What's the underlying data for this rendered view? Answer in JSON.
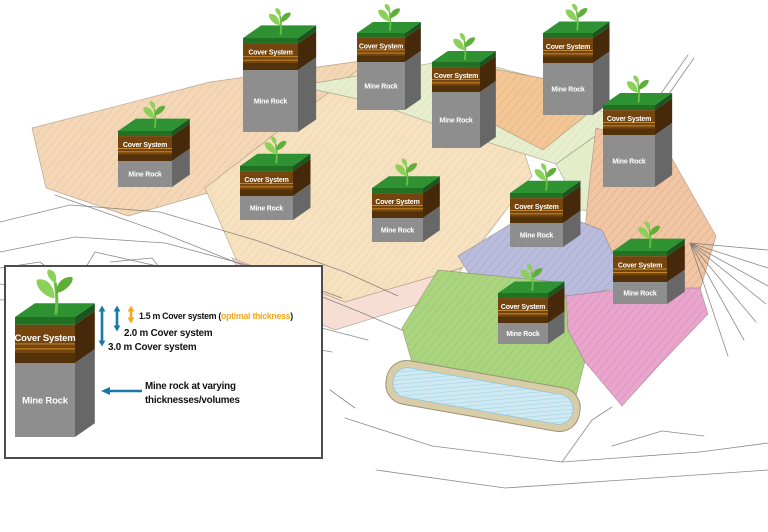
{
  "title": "Mine site cover system concept sketch",
  "legend": {
    "items": [
      {
        "pre": "1.5 m Cover system (",
        "highlight": "optimal thickness",
        "post": ")"
      },
      {
        "label": "2.0 m Cover system"
      },
      {
        "label": "3.0 m Cover system"
      }
    ],
    "note": {
      "line1": "Mine rock at varying",
      "line2": "thicknesses/volumes"
    },
    "arrows": [
      {
        "x": 102,
        "y1": 306,
        "y2": 346,
        "color": "blue",
        "meaning": "3.0 m cover thickness"
      },
      {
        "x": 117,
        "y1": 306,
        "y2": 331,
        "color": "blue",
        "meaning": "2.0 m cover thickness"
      },
      {
        "x": 131,
        "y1": 306,
        "y2": 323,
        "color": "orange",
        "meaning": "1.5 m optimal cover thickness"
      }
    ],
    "note_arrow": {
      "x1": 142,
      "x2": 104,
      "y": 391
    },
    "column_figure": {
      "x": 15,
      "y": 317,
      "w": 60,
      "ch": 46,
      "rh": 74
    }
  },
  "map": {
    "column_labels": {
      "cover": "Cover System",
      "rock": "Mine Rock"
    },
    "columns": [
      {
        "x": 243,
        "y": 38,
        "w": 55,
        "ch": 32,
        "rh": 62
      },
      {
        "x": 357,
        "y": 33,
        "w": 48,
        "ch": 29,
        "rh": 48
      },
      {
        "x": 432,
        "y": 62,
        "w": 48,
        "ch": 30,
        "rh": 56
      },
      {
        "x": 543,
        "y": 33,
        "w": 50,
        "ch": 30,
        "rh": 52
      },
      {
        "x": 603,
        "y": 105,
        "w": 52,
        "ch": 30,
        "rh": 52
      },
      {
        "x": 118,
        "y": 131,
        "w": 54,
        "ch": 30,
        "rh": 26
      },
      {
        "x": 240,
        "y": 166,
        "w": 53,
        "ch": 30,
        "rh": 24
      },
      {
        "x": 372,
        "y": 188,
        "w": 51,
        "ch": 30,
        "rh": 24
      },
      {
        "x": 510,
        "y": 193,
        "w": 53,
        "ch": 30,
        "rh": 24
      },
      {
        "x": 613,
        "y": 251,
        "w": 54,
        "ch": 31,
        "rh": 22
      },
      {
        "x": 498,
        "y": 293,
        "w": 50,
        "ch": 30,
        "rh": 21
      }
    ],
    "regions": [
      {
        "name": "peach-west",
        "fill": "#f3d7b7",
        "hatch": "#e6bb8f",
        "points": "32,128 210,82 368,60 330,128 232,186 128,216 46,188"
      },
      {
        "name": "tan-center",
        "fill": "#f6e1c1",
        "hatch": "#eccd9f",
        "points": "205,188 368,62 505,94 532,176 462,268 345,304 240,268"
      },
      {
        "name": "rose-center-south",
        "fill": "#f7ded4",
        "hatch": "",
        "points": "232,258 345,302 462,268 448,295 335,330 255,298"
      },
      {
        "name": "green-north",
        "fill": "#e7eecf",
        "hatch": "#cfdfa8",
        "points": "298,86 462,58 545,80 618,120 556,164 468,136 372,102"
      },
      {
        "name": "orange-north",
        "fill": "#f2c697",
        "hatch": "#e4a86c",
        "points": "468,64 552,80 590,112 543,150 478,116"
      },
      {
        "name": "green-east",
        "fill": "#e3edca",
        "hatch": "",
        "points": "556,164 618,120 672,150 650,214 580,210"
      },
      {
        "name": "salmon-east",
        "fill": "#f0c6a4",
        "hatch": "#dd9e72",
        "points": "596,128 666,148 716,236 700,290 630,300 584,240 590,178"
      },
      {
        "name": "lavender-band",
        "fill": "#babcdc",
        "hatch": "#999bc8",
        "points": "458,256 540,206 602,230 628,286 556,300 478,288"
      },
      {
        "name": "green-south",
        "fill": "#abd480",
        "hatch": "#8cc25a",
        "points": "438,270 556,282 592,334 576,396 498,416 420,390 402,328"
      },
      {
        "name": "pink-east-south",
        "fill": "#e9a6cd",
        "hatch": "#da7ab4",
        "points": "566,296 630,288 700,288 708,314 660,364 622,406 585,362 568,330"
      }
    ],
    "pond": {
      "cx": 483,
      "cy": 396,
      "rot": 10,
      "outer_w": 196,
      "outer_h": 44,
      "inner_w": 182,
      "inner_h": 30
    }
  },
  "colors": {
    "arrow_blue": "#1878a8",
    "arrow_orange": "#f5a81c",
    "column": {
      "top_green": "#2f9232",
      "front_green": "#227024",
      "side_green": "#1b5520",
      "front_brown": "#74450f",
      "dark_brown": "#53310a",
      "side_brown": "#46290a",
      "stripe_orange": "#cf8f2e",
      "front_gray": "#8e8e8e",
      "side_gray": "#676767",
      "label_text": "#ffffff"
    },
    "plant": {
      "stem": "#6abf45",
      "leaf_light": "#8bd159",
      "leaf_dark": "#5fae3a"
    },
    "pond": {
      "bank": "#d9cda8",
      "water": "#cfe9f2",
      "water_line": "#8ec6db"
    },
    "sketch_line": "#6e6e6e",
    "legend_border": "#4d4d4d"
  }
}
